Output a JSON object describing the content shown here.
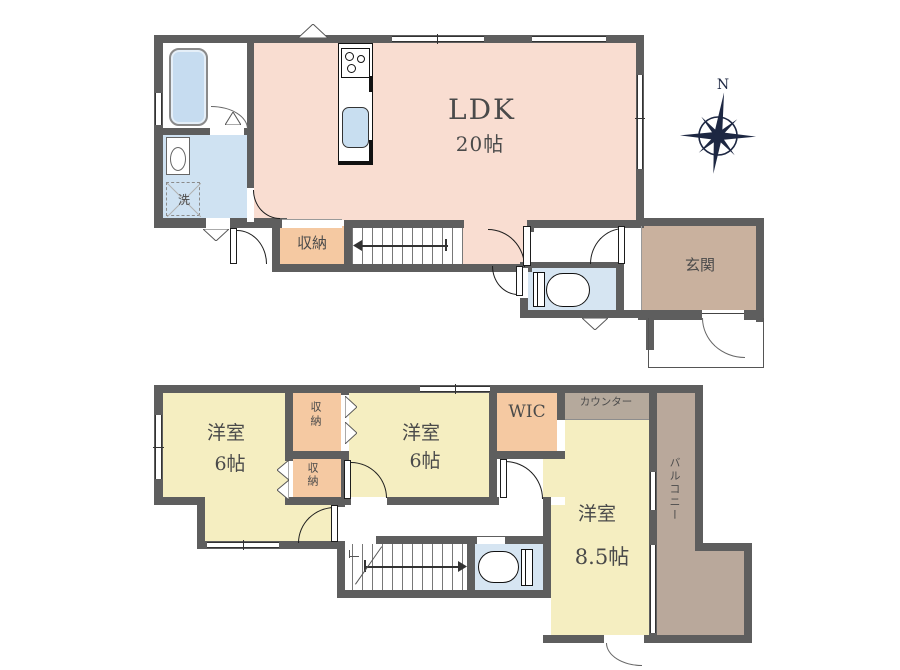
{
  "plan": {
    "floor1": {
      "ldk_label": "LDK",
      "ldk_size": "20帖",
      "laundry_label": "洗",
      "storage_label": "収納",
      "entrance_label": "玄関"
    },
    "floor2": {
      "room_left_label": "洋室",
      "room_left_size": "6帖",
      "closet_top_label": "収納",
      "closet_bottom_label": "収納",
      "room_mid_label": "洋室",
      "room_mid_size": "6帖",
      "wic_label": "WIC",
      "counter_label": "カウンター",
      "room_main_label": "洋室",
      "room_main_size": "8.5帖",
      "balcony_label": "バルコニー"
    },
    "compass_label": "N",
    "colors": {
      "wall": "#5e5e5e",
      "ldk": "#f9ddd1",
      "bedroom": "#f5eec1",
      "storage": "#f5c9a2",
      "wet": "#cfe2f2",
      "toilet": "#d6e5f2",
      "tub": "#c6dcf0",
      "sink": "#c8def0",
      "entrance": "#c9b19e",
      "counter": "#b5a99c",
      "balcony": "#b9a89b",
      "compass": "#1d2742"
    }
  }
}
